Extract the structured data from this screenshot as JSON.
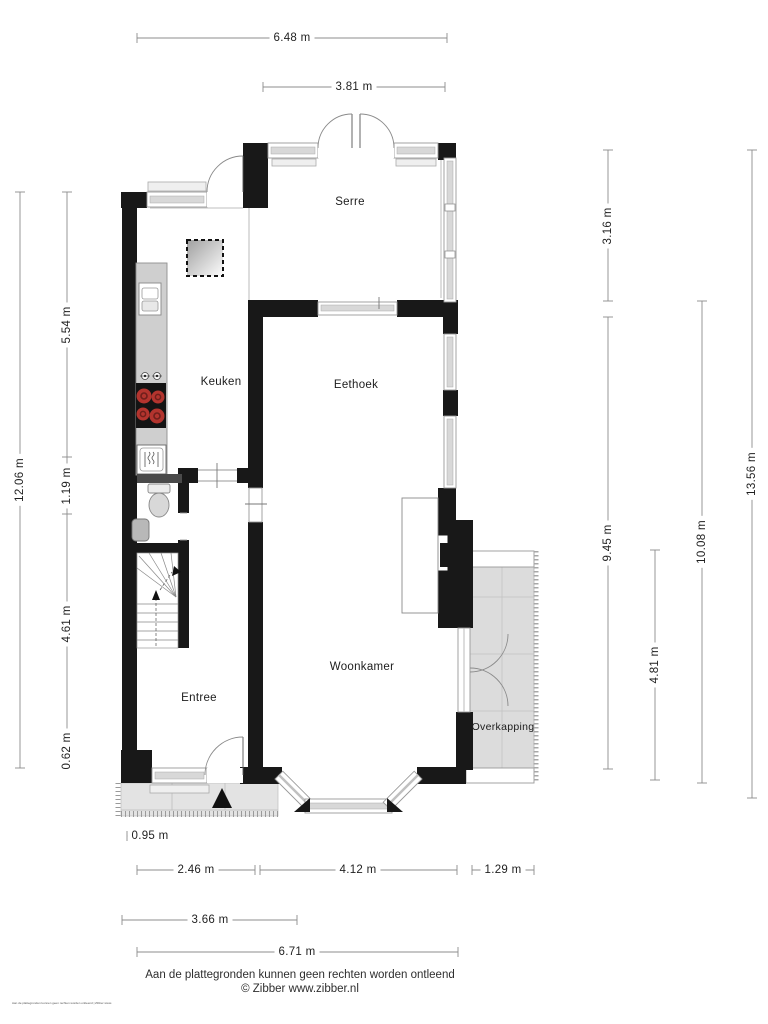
{
  "title": "Floor plan - begane grond",
  "rooms": {
    "serre": "Serre",
    "keuken": "Keuken",
    "eethoek": "Eethoek",
    "woonkamer": "Woonkamer",
    "entree": "Entree",
    "overkapping": "Overkapping"
  },
  "dimensions": {
    "top": [
      {
        "label": "6.48 m"
      },
      {
        "label": "3.81 m"
      }
    ],
    "left": [
      {
        "label": "12.06 m"
      },
      {
        "label": "5.54 m"
      },
      {
        "label": "1.19 m"
      },
      {
        "label": "4.61 m"
      },
      {
        "label": "0.62 m"
      }
    ],
    "right": [
      {
        "label": "3.16 m"
      },
      {
        "label": "9.45 m"
      },
      {
        "label": "13.56 m"
      },
      {
        "label": "10.08 m"
      },
      {
        "label": "4.81 m"
      }
    ],
    "bottom": [
      {
        "label": "0.95 m"
      },
      {
        "label": "2.46 m"
      },
      {
        "label": "4.12 m"
      },
      {
        "label": "1.29 m"
      },
      {
        "label": "3.66 m"
      },
      {
        "label": "6.71 m"
      }
    ]
  },
  "icons": {
    "stove": "stove-icon",
    "sink": "sink-icon",
    "dishwasher": "dishwasher-icon",
    "toilet": "toilet-icon",
    "basin": "basin-icon",
    "stairs": "stairs-icon",
    "rooflight": "rooflight-icon",
    "entrance_arrow": "entrance-arrow-icon"
  },
  "footer": {
    "disclaimer": "Aan de plattegronden kunnen geen rechten worden ontleend",
    "credit": "© Zibber www.zibber.nl",
    "micro_text": "Aan de plattegronden kunnen geen rechten worden ontleend | Zibber www.zibber.nl"
  },
  "colors": {
    "wall": "#181818",
    "window_fill": "#d8d8d8",
    "floor_gray": "#dcdcdc",
    "pavement_gray": "#e3e3e3",
    "counter_gray": "#cfcfcf",
    "burner_red": "#b3342e",
    "dimension_line": "#8c8c8c"
  }
}
